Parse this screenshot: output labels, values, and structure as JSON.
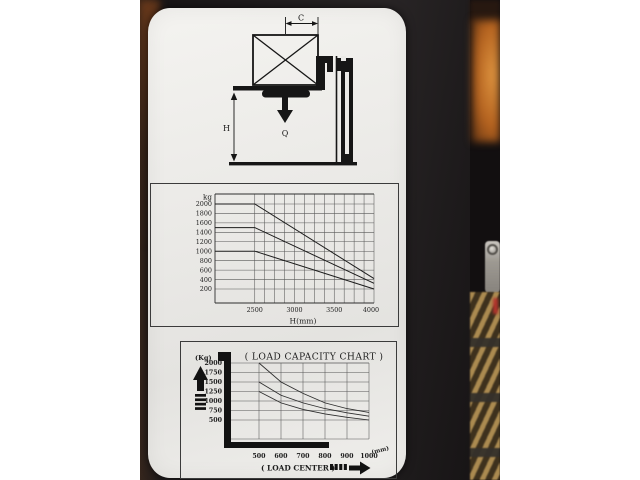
{
  "colors": {
    "label_paper": "#ebeae7",
    "ink": "#1c1c1c",
    "machine_body": "#1b1819",
    "background_orange": "#c97f2f",
    "fence_tan": "#ab8a50"
  },
  "top_diagram": {
    "c_label": "C",
    "h_label": "H",
    "q_label": "Q"
  },
  "chart_data": [
    {
      "type": "line",
      "name": "lift-height-capacity-chart",
      "title": "",
      "ylabel": "kg",
      "xlabel": "H(mm)",
      "y_ticks": [
        2000,
        1800,
        1600,
        1400,
        1200,
        1000,
        800,
        600,
        400,
        200
      ],
      "x_ticks": [
        2500,
        3000,
        3500,
        4000
      ],
      "x_range": [
        2000,
        4000
      ],
      "y_range": [
        0,
        2100
      ],
      "x_minor_grid_step": 125,
      "grid": true,
      "legend": "none",
      "series": [
        {
          "name": "capacity-line-2000kg",
          "points": [
            [
              2000,
              2000
            ],
            [
              2500,
              2000
            ],
            [
              4000,
              420
            ]
          ]
        },
        {
          "name": "capacity-line-1500kg",
          "points": [
            [
              2000,
              1500
            ],
            [
              2500,
              1500
            ],
            [
              4000,
              320
            ]
          ]
        },
        {
          "name": "capacity-line-1000kg",
          "points": [
            [
              2000,
              1000
            ],
            [
              2500,
              1000
            ],
            [
              4000,
              200
            ]
          ]
        }
      ]
    },
    {
      "type": "line",
      "name": "load-center-capacity-chart",
      "title": "( LOAD CAPACITY CHART )",
      "ylabel": "(Kg)",
      "xlabel": "(mm)",
      "x_caption": "( LOAD CENTER )",
      "y_ticks": [
        2000,
        1750,
        1500,
        1250,
        1000,
        750,
        500
      ],
      "x_ticks": [
        500,
        600,
        700,
        800,
        900,
        1000
      ],
      "x": [
        500,
        600,
        700,
        800,
        900,
        1000
      ],
      "y_range": [
        0,
        2000
      ],
      "grid": true,
      "legend": "none",
      "series": [
        {
          "name": "capacity-curve-top",
          "values": [
            2000,
            1500,
            1200,
            950,
            800,
            700
          ]
        },
        {
          "name": "capacity-curve-middle",
          "values": [
            1500,
            1150,
            950,
            800,
            690,
            600
          ]
        },
        {
          "name": "capacity-curve-bottom",
          "values": [
            1250,
            950,
            780,
            660,
            570,
            500
          ]
        }
      ]
    }
  ]
}
